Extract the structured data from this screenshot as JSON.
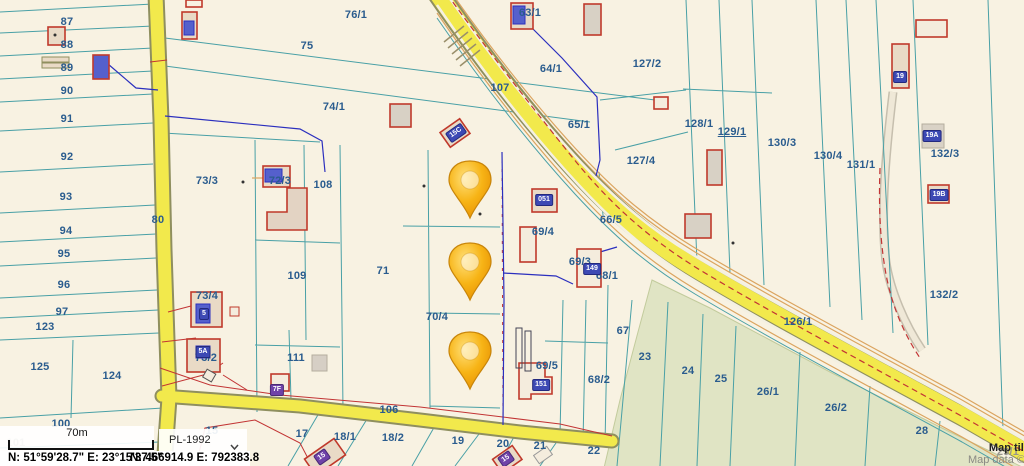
{
  "map": {
    "colors": {
      "background": "#f8f2e2",
      "road_yellow": "#f2e94c",
      "road_casing": "#8f8f5f",
      "parcel_line": "#49a0a6",
      "navy_line": "#2b2fbe",
      "red_line": "#c23434",
      "orange_line": "#dba45f",
      "forest_fill": "#e0e4c4",
      "label_color": "#2a5c8e",
      "pin_fill": "#f6b40e",
      "badge_blue": "#3d49b4",
      "badge_purple": "#6f42a8"
    },
    "parcel_labels": [
      {
        "t": "87",
        "x": 67,
        "y": 22
      },
      {
        "t": "88",
        "x": 67,
        "y": 45
      },
      {
        "t": "89",
        "x": 67,
        "y": 68
      },
      {
        "t": "90",
        "x": 67,
        "y": 91
      },
      {
        "t": "91",
        "x": 67,
        "y": 119
      },
      {
        "t": "92",
        "x": 67,
        "y": 157
      },
      {
        "t": "93",
        "x": 66,
        "y": 197
      },
      {
        "t": "94",
        "x": 66,
        "y": 231
      },
      {
        "t": "95",
        "x": 64,
        "y": 254
      },
      {
        "t": "96",
        "x": 64,
        "y": 285
      },
      {
        "t": "97",
        "x": 62,
        "y": 312
      },
      {
        "t": "123",
        "x": 45,
        "y": 327
      },
      {
        "t": "125",
        "x": 40,
        "y": 367
      },
      {
        "t": "124",
        "x": 112,
        "y": 376
      },
      {
        "t": "100",
        "x": 61,
        "y": 424
      },
      {
        "t": "101",
        "x": 16,
        "y": 443,
        "c": "muted"
      },
      {
        "t": "80",
        "x": 158,
        "y": 220
      },
      {
        "t": "73/3",
        "x": 207,
        "y": 181
      },
      {
        "t": "72/3",
        "x": 280,
        "y": 181
      },
      {
        "t": "73/4",
        "x": 207,
        "y": 296
      },
      {
        "t": "73/2",
        "x": 206,
        "y": 358
      },
      {
        "t": "108",
        "x": 323,
        "y": 185
      },
      {
        "t": "109",
        "x": 297,
        "y": 276
      },
      {
        "t": "111",
        "x": 296,
        "y": 358
      },
      {
        "t": "71",
        "x": 383,
        "y": 271
      },
      {
        "t": "76/1",
        "x": 356,
        "y": 15
      },
      {
        "t": "75",
        "x": 307,
        "y": 46
      },
      {
        "t": "74/1",
        "x": 334,
        "y": 107
      },
      {
        "t": "107",
        "x": 500,
        "y": 88
      },
      {
        "t": "63/1",
        "x": 530,
        "y": 13
      },
      {
        "t": "64/1",
        "x": 551,
        "y": 69
      },
      {
        "t": "65/1",
        "x": 579,
        "y": 125
      },
      {
        "t": "127/2",
        "x": 647,
        "y": 64
      },
      {
        "t": "127/4",
        "x": 641,
        "y": 161
      },
      {
        "t": "128/1",
        "x": 699,
        "y": 124
      },
      {
        "t": "129/1",
        "x": 732,
        "y": 132,
        "c": "link"
      },
      {
        "t": "130/3",
        "x": 782,
        "y": 143
      },
      {
        "t": "130/4",
        "x": 828,
        "y": 156
      },
      {
        "t": "131/1",
        "x": 861,
        "y": 165
      },
      {
        "t": "132/3",
        "x": 945,
        "y": 154
      },
      {
        "t": "132/2",
        "x": 944,
        "y": 295
      },
      {
        "t": "66/5",
        "x": 611,
        "y": 220
      },
      {
        "t": "69/4",
        "x": 543,
        "y": 232
      },
      {
        "t": "69/3",
        "x": 580,
        "y": 262
      },
      {
        "t": "68/1",
        "x": 607,
        "y": 276
      },
      {
        "t": "69/5",
        "x": 547,
        "y": 366
      },
      {
        "t": "68/2",
        "x": 599,
        "y": 380
      },
      {
        "t": "67",
        "x": 623,
        "y": 331
      },
      {
        "t": "126/1",
        "x": 798,
        "y": 322
      },
      {
        "t": "23",
        "x": 645,
        "y": 357
      },
      {
        "t": "24",
        "x": 688,
        "y": 371
      },
      {
        "t": "25",
        "x": 721,
        "y": 379
      },
      {
        "t": "26/1",
        "x": 768,
        "y": 392
      },
      {
        "t": "26/2",
        "x": 836,
        "y": 408
      },
      {
        "t": "28",
        "x": 922,
        "y": 431
      },
      {
        "t": "106",
        "x": 389,
        "y": 410
      },
      {
        "t": "15",
        "x": 212,
        "y": 431
      },
      {
        "t": "17",
        "x": 302,
        "y": 434
      },
      {
        "t": "18/1",
        "x": 345,
        "y": 437
      },
      {
        "t": "18/2",
        "x": 393,
        "y": 438
      },
      {
        "t": "19",
        "x": 458,
        "y": 441
      },
      {
        "t": "20",
        "x": 503,
        "y": 444
      },
      {
        "t": "21",
        "x": 540,
        "y": 446
      },
      {
        "t": "22",
        "x": 594,
        "y": 451
      },
      {
        "t": "70/1",
        "x": 471,
        "y": 186
      },
      {
        "t": "70",
        "x": 471,
        "y": 268
      },
      {
        "t": "70/4",
        "x": 437,
        "y": 317
      },
      {
        "t": "29/1",
        "x": 1008,
        "y": 452,
        "c": "muted"
      }
    ],
    "house_badges": [
      {
        "t": "051",
        "x": 544,
        "y": 200,
        "r": 0,
        "c": "blue"
      },
      {
        "t": "149",
        "x": 592,
        "y": 269,
        "r": 0,
        "c": "blue"
      },
      {
        "t": "151",
        "x": 541,
        "y": 385,
        "r": 0,
        "c": "blue"
      },
      {
        "t": "19",
        "x": 900,
        "y": 77,
        "r": 0,
        "c": "blue"
      },
      {
        "t": "19A",
        "x": 932,
        "y": 136,
        "r": 0,
        "c": "blue"
      },
      {
        "t": "19B",
        "x": 939,
        "y": 195,
        "r": 0,
        "c": "blue"
      },
      {
        "t": "15C",
        "x": 456,
        "y": 133,
        "r": -35,
        "c": "blue"
      },
      {
        "t": "7F",
        "x": 277,
        "y": 390,
        "r": 0,
        "c": "purple"
      },
      {
        "t": "5",
        "x": 204,
        "y": 314,
        "r": 0,
        "c": "blue"
      },
      {
        "t": "5A",
        "x": 203,
        "y": 352,
        "r": 0,
        "c": "blue"
      },
      {
        "t": "15",
        "x": 322,
        "y": 457,
        "r": -35,
        "c": "purple"
      },
      {
        "t": "15",
        "x": 506,
        "y": 459,
        "r": -35,
        "c": "purple"
      }
    ],
    "pins": [
      {
        "x": 470,
        "y": 218
      },
      {
        "x": 470,
        "y": 300
      },
      {
        "x": 470,
        "y": 389
      }
    ]
  },
  "controls": {
    "scale_bar_label": "70m",
    "crs_value": "PL-1992",
    "coordinates_geographic": "N: 51°59'28.7\"  E: 23°15'37.5\"",
    "coordinates_projected": "N: 466914.9   E: 792383.8",
    "attribution_line1": "Map tiles",
    "attribution_line2": "Map data © C"
  }
}
